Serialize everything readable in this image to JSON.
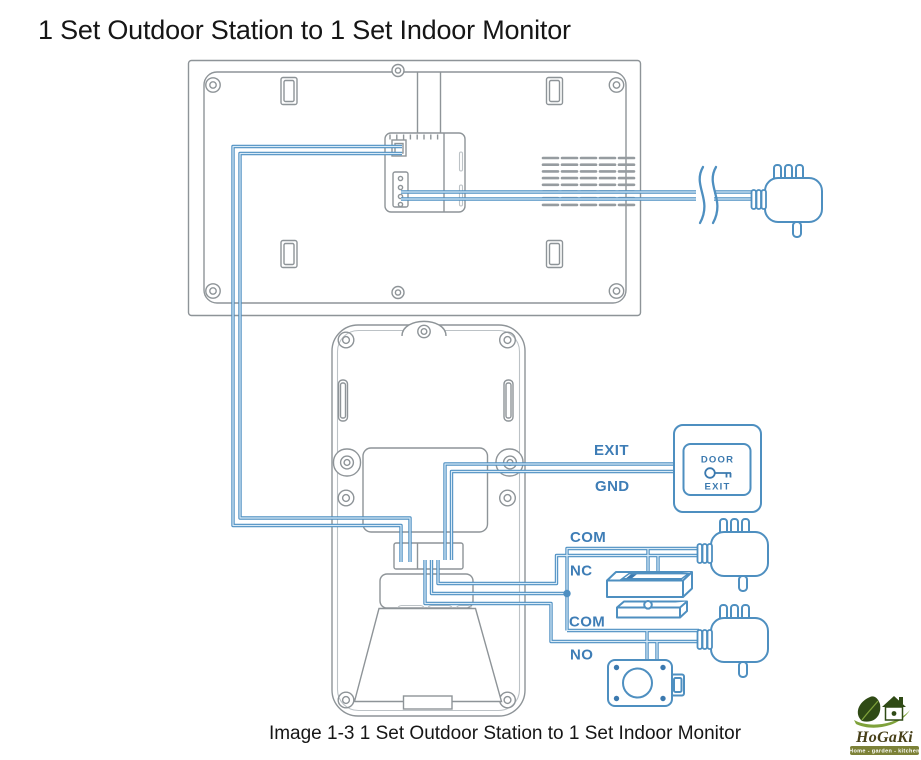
{
  "title": "1 Set Outdoor Station to 1 Set Indoor Monitor",
  "caption": "Image 1-3 1 Set Outdoor Station to 1 Set Indoor Monitor",
  "wire_labels": {
    "exit": "EXIT",
    "gnd": "GND",
    "com_top": "COM",
    "nc": "NC",
    "com_bottom": "COM",
    "no": "NO"
  },
  "exit_button": {
    "top_label": "DOOR",
    "bottom_label": "EXIT",
    "icon": "key-icon"
  },
  "logo": {
    "brand": "HoGaKi",
    "tagline": "Home - garden - kitchen"
  },
  "colors": {
    "wire_blue": "#4D8FC2",
    "label_blue": "#3E7DB6",
    "device_blue": "#4E8FC0",
    "outline_gray": "#8E9498",
    "text_black": "#161616",
    "logo_green_dark": "#2F4A15",
    "logo_green_light": "#7FA23B",
    "logo_olive": "#7C8137",
    "logo_text": "#473F18"
  },
  "components": {
    "indoor_monitor": "indoor-monitor-rear-panel",
    "outdoor_station": "outdoor-station-rear-panel",
    "power_adapter_count": 3,
    "cable_break": "cable-break-symbol",
    "door_exit_button": "door-exit-button",
    "magnetic_lock": "magnetic-lock-with-armature-plate",
    "electric_lock": "electric-rim-lock",
    "junction": "wire-junction-dot"
  }
}
